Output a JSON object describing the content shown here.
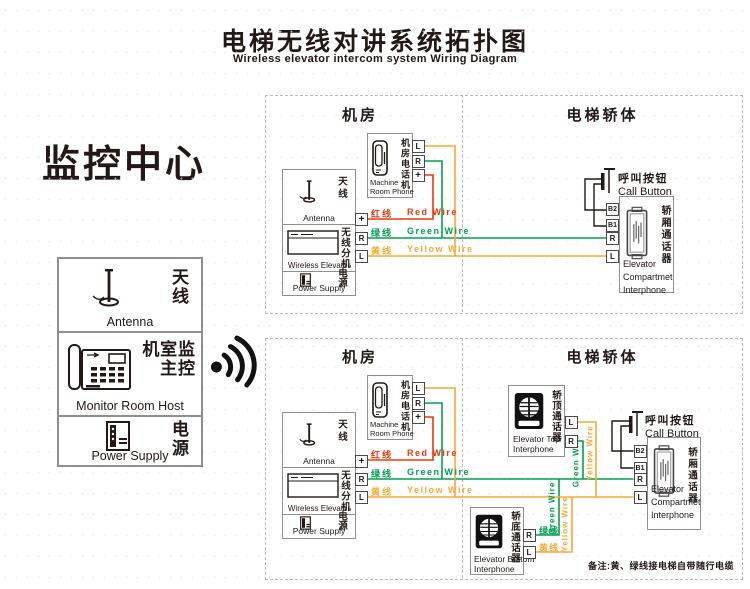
{
  "colors": {
    "red": "#e8380d",
    "green": "#00a150",
    "yellow": "#f7a933",
    "ink": "#231815",
    "border": "#8f8f8f",
    "dash": "#bdb9b5"
  },
  "header": {
    "title_zh": "电梯无线对讲系统拓扑图",
    "title_en": "Wireless elevator intercom system Wiring Diagram"
  },
  "monitor_center": {
    "heading": "监控中心",
    "antenna_zh": "天线",
    "antenna_en": "Antenna",
    "host_zh": "监控室主机",
    "host_en": "Monitor Room Host",
    "power_zh": "电源",
    "power_en": "Power Supply"
  },
  "sections": {
    "machine_room": "机房",
    "elevator_car": "电梯轿体"
  },
  "station": {
    "antenna_zh": "天线",
    "antenna_en": "Antenna",
    "wireless_zh": "无线分机",
    "wireless_en": "Wireless Elevator",
    "power_zh": "电源",
    "power_en": "Power Supply"
  },
  "phone": {
    "zh": "机房电话机",
    "en1": "Machine",
    "en2": "Room Phone"
  },
  "call_button": {
    "zh": "呼叫按钮",
    "en": "Call Button"
  },
  "compartment": {
    "zh": "轿厢通话器",
    "en1": "Elevator",
    "en2": "Compartmet",
    "en3": "Interphone"
  },
  "top_interphone": {
    "zh": "轿顶通话器",
    "en1": "Elevator Top",
    "en2": "Interphone"
  },
  "bottom_interphone": {
    "zh": "轿底通话器",
    "en1": "Elevator Bottom",
    "en2": "Interphone"
  },
  "wires": {
    "red_zh": "红线",
    "red_en": "Red Wire",
    "green_zh": "绿线",
    "green_en": "Green Wire",
    "yellow_zh": "黄线",
    "yellow_en": "Yellow Wire"
  },
  "terminals": {
    "plus": "+",
    "r": "R",
    "l": "L",
    "b1": "B1",
    "b2": "B2"
  },
  "note": "备注:黄、绿线接电梯自带随行电缆",
  "icons": {
    "signal": "wireless-signal-icon",
    "antenna": "antenna-icon",
    "desk_phone": "desk-phone-icon",
    "power": "power-supply-icon",
    "wall_phone": "wall-phone-icon",
    "radio_unit": "radio-unit-icon",
    "speaker": "speaker-interphone-icon",
    "intercom": "intercom-panel-icon",
    "push_button": "push-button-icon"
  }
}
